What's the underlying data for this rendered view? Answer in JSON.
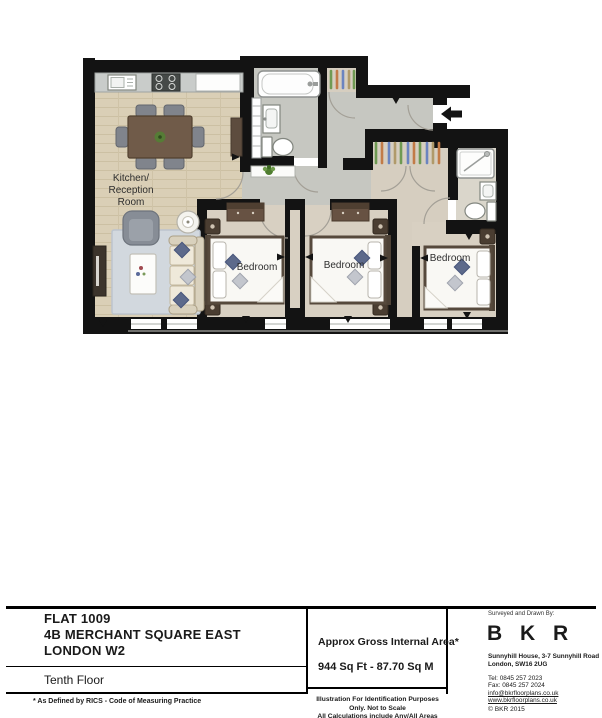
{
  "plan": {
    "rooms": {
      "kitchen_label_line1": "Kitchen/",
      "kitchen_label_line2": "Reception",
      "kitchen_label_line3": "Room",
      "bedroom1_label": "Bedroom",
      "bedroom2_label": "Bedroom",
      "bedroom3_label": "Bedroom"
    }
  },
  "title_block": {
    "property_name": "FLAT 1009",
    "address_line1": "4B MERCHANT SQUARE EAST",
    "address_line2": "LONDON W2",
    "floor_label": "Tenth Floor",
    "rics_note": "* As Defined by RICS - Code of Measuring Practice",
    "area": {
      "label": "Approx Gross Internal Area*",
      "value": "944 Sq Ft  -  87.70 Sq M"
    },
    "disclaimer_line1": "Illustration For Identification Purposes Only.  Not to Scale",
    "disclaimer_line2": "All Calculations include Any/All Areas Under 1.5m Head Height."
  },
  "surveyor_block": {
    "heading": "Surveyed and Drawn By:",
    "brand": "B K R",
    "address_line1": "Sunnyhill House, 3-7 Sunnyhill Road",
    "address_line2": "London, SW16 2UG",
    "tel": "Tel:  0845 257 2023",
    "fax": "Fax: 0845 257 2024",
    "email": "info@bkrfloorplans.co.uk",
    "website": "www.bkrfloorplans.co.uk",
    "copyright": "©   BKR 2015"
  },
  "colors": {
    "wall": "#131313",
    "wood_floor": "#dacfb6",
    "grey_floor": "#c6c7c1",
    "beige_floor": "#d6cec0",
    "rug": "#d2d8de",
    "navy_pillow": "#5d6a8b",
    "hanger_green": "#6f9a53",
    "hanger_blue": "#6b84c0",
    "hanger_orange": "#c27b47",
    "plant_green": "#4f7d2f"
  }
}
